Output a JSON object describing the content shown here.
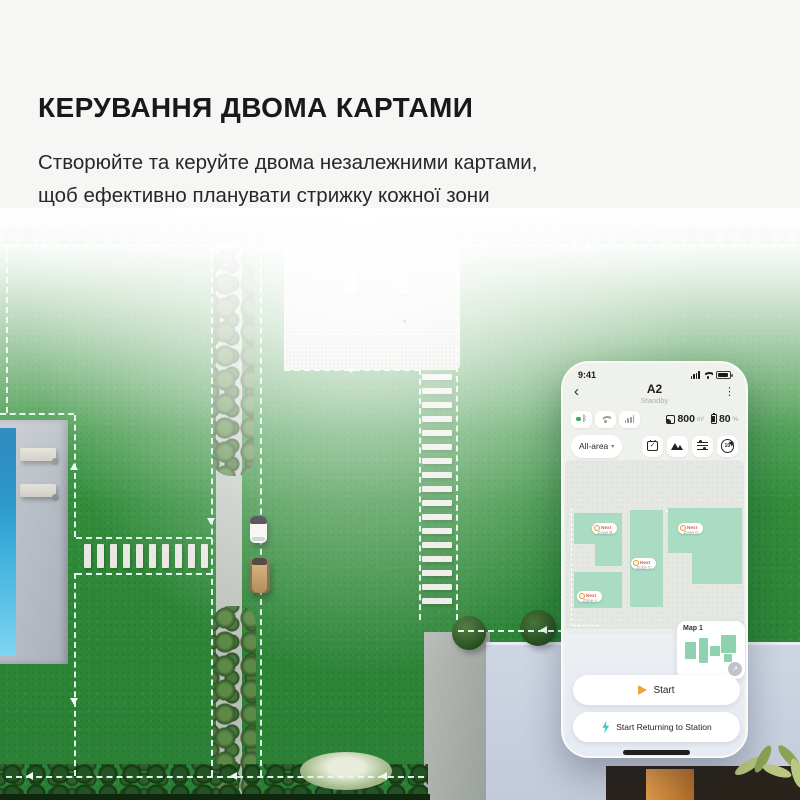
{
  "hero": {
    "title": "КЕРУВАННЯ ДВОМА КАРТАМИ",
    "subtitle_line1": "Створюйте та керуйте двома незалежними картами,",
    "subtitle_line2": "щоб ефективно планувати стрижку кожної зони"
  },
  "phone": {
    "status_bar": {
      "time": "9:41"
    },
    "header": {
      "title": "A2",
      "status": "Standby"
    },
    "connectivity": {
      "area_value": "800",
      "area_unit": "m²",
      "battery_value": "80",
      "battery_unit": "%"
    },
    "toolbar": {
      "zone_selector": "All-area",
      "spiral_badge": "10"
    },
    "map": {
      "zones": [
        {
          "label": "Zone B",
          "badge": "Next"
        },
        {
          "label": "Zone A",
          "badge": "Next"
        },
        {
          "label": "Zone C",
          "badge": "Next"
        },
        {
          "label": "Zone D",
          "badge": "Next"
        }
      ]
    },
    "map_card": {
      "label": "Map 1"
    },
    "actions": {
      "start": "Start",
      "return_to_station": "Start Returning to Station"
    }
  },
  "icons": {
    "back": "‹",
    "menu": "⋮",
    "chevron_down": "▾",
    "bluetooth": "ᛒ",
    "check": "✓",
    "expand": "↗"
  },
  "colors": {
    "accent_green": "#31c57d",
    "zone_mint": "#a9dcc2",
    "start_orange": "#f0a33a",
    "return_teal": "#36cfc0",
    "dashed_boundary": "#e7fbf1"
  }
}
